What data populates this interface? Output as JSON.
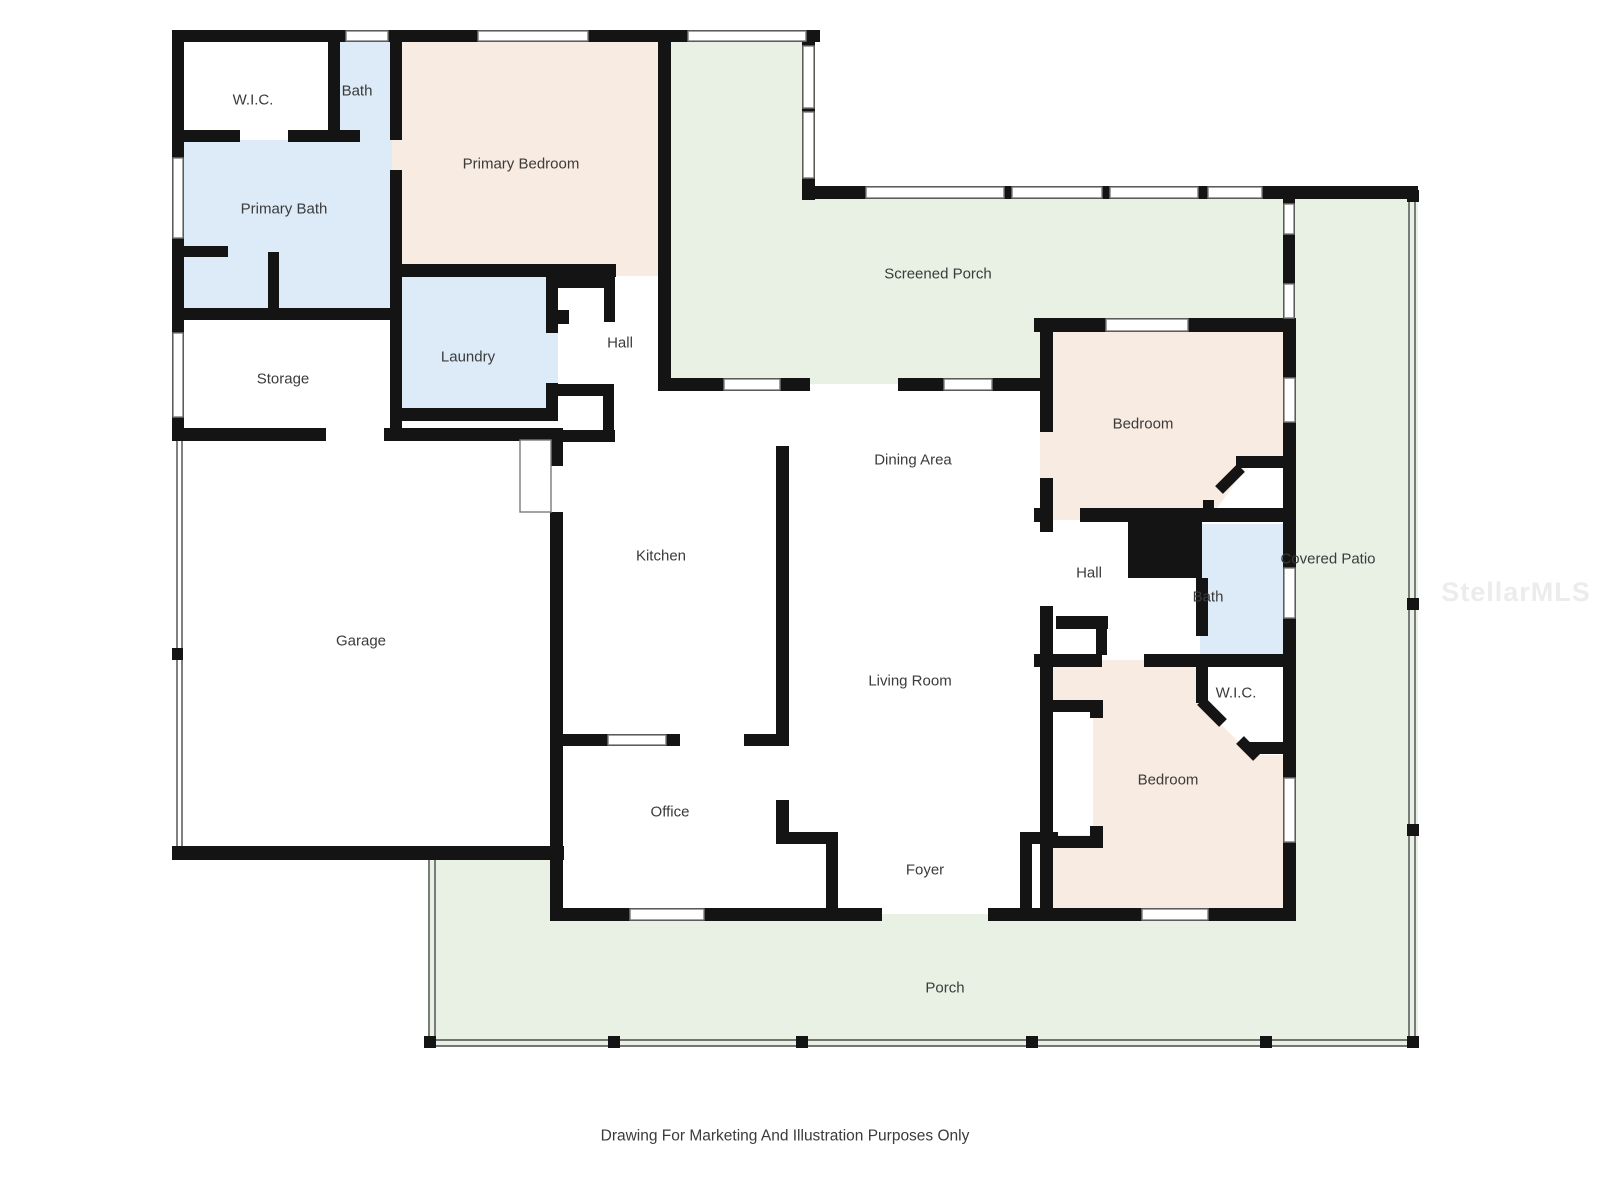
{
  "colors": {
    "wall": "#141414",
    "bedroom_fill": "#f8ebe1",
    "bath_fill": "#dcebf7",
    "porch_fill": "#e8f1e4",
    "white_fill": "#ffffff",
    "label": "#3b3b3b",
    "rail": "#4a4a4a",
    "window_stroke": "#7a7a7a",
    "watermark": "#ececec"
  },
  "rooms": {
    "wic1": {
      "label": "W.I.C."
    },
    "bath1": {
      "label": "Bath"
    },
    "primary_bedroom": {
      "label": "Primary Bedroom"
    },
    "primary_bath": {
      "label": "Primary Bath"
    },
    "storage": {
      "label": "Storage"
    },
    "laundry": {
      "label": "Laundry"
    },
    "hall1": {
      "label": "Hall"
    },
    "screened_porch": {
      "label": "Screened Porch"
    },
    "bedroom1": {
      "label": "Bedroom"
    },
    "dining": {
      "label": "Dining Area"
    },
    "kitchen": {
      "label": "Kitchen"
    },
    "hall2": {
      "label": "Hall"
    },
    "bath2": {
      "label": "Bath"
    },
    "covered_patio": {
      "label": "Covered Patio"
    },
    "wic2": {
      "label": "W.I.C."
    },
    "garage": {
      "label": "Garage"
    },
    "living": {
      "label": "Living Room"
    },
    "office": {
      "label": "Office"
    },
    "bedroom2": {
      "label": "Bedroom"
    },
    "foyer": {
      "label": "Foyer"
    },
    "porch": {
      "label": "Porch"
    }
  },
  "footer": {
    "disclaimer": "Drawing For Marketing And Illustration Purposes Only"
  },
  "watermark": {
    "text": "StellarMLS"
  }
}
